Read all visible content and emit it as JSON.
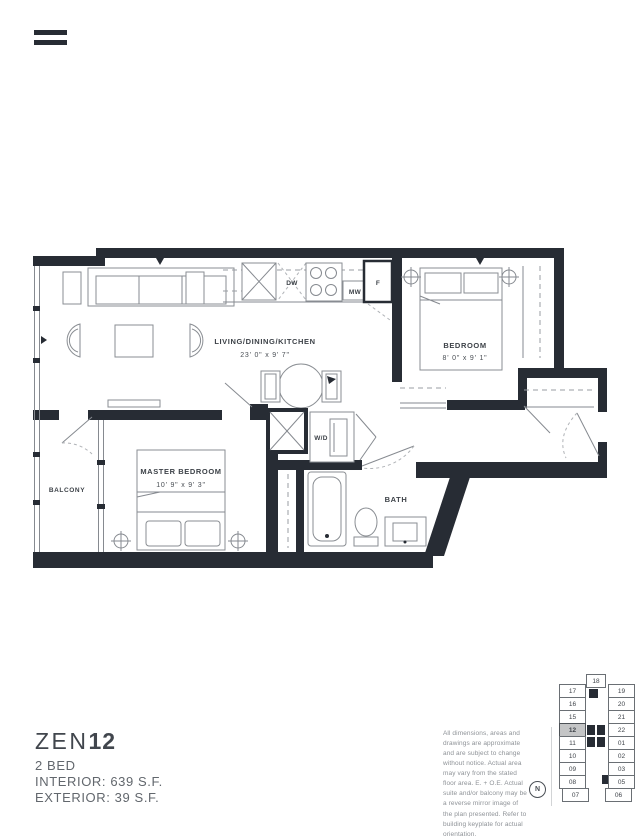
{
  "menu": {
    "icon": "hamburger"
  },
  "floorplan": {
    "labels": {
      "living": {
        "name": "LIVING/DINING/KITCHEN",
        "dims": "23' 0\" x 9' 7\""
      },
      "bedroom": {
        "name": "BEDROOM",
        "dims": "8' 0\" x 9' 1\""
      },
      "master": {
        "name": "MASTER BEDROOM",
        "dims": "10' 9\" x 9' 3\""
      },
      "balcony": "BALCONY",
      "bath": "BATH",
      "washer_dryer": "W/D",
      "dishwasher": "DW",
      "microwave": "MW",
      "fridge": "F"
    },
    "wall_color": "#272c34",
    "line_color": "#868a90"
  },
  "unit_info": {
    "name_light": "ZEN",
    "name_bold": "12",
    "bed_type": "2 BED",
    "interior": "INTERIOR: 639 S.F.",
    "exterior": "EXTERIOR: 39 S.F."
  },
  "disclaimer": "All dimensions, areas and drawings are approximate and are subject to change without notice. Actual area may vary from the stated floor area. E. + O.E. Actual suite and/or balcony may be a reverse mirror image of the plan presented. Refer to building keyplate for actual orientation.",
  "compass": {
    "label": "N"
  },
  "keyplate": {
    "highlighted_unit": "12",
    "center_top": "18",
    "left": [
      "17",
      "16",
      "15",
      "12",
      "11",
      "10",
      "09",
      "08",
      "07"
    ],
    "right": [
      "19",
      "20",
      "21",
      "22",
      "01",
      "02",
      "03",
      "05",
      "06"
    ]
  }
}
